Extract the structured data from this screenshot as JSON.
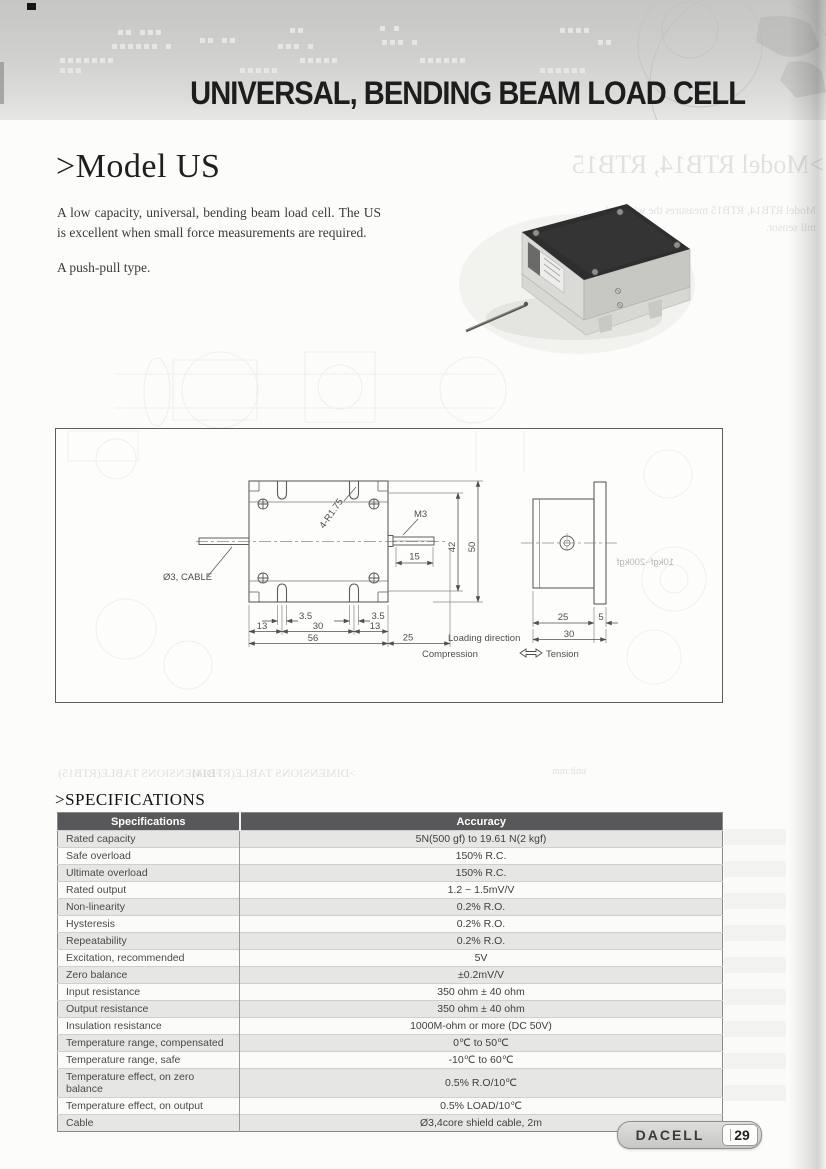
{
  "banner": {
    "title": "UNIVERSAL, BENDING BEAM LOAD CELL"
  },
  "model": {
    "heading": ">Model US",
    "paragraph": "A low capacity, universal, bending beam load cell. The US is excellent when small force measurements are required.",
    "paragraph2": "A push-pull type."
  },
  "ghost": {
    "model_heading": ">Model RTB14, RTB15",
    "model_line1": "Model RTB14, RTB15 measures the wire and",
    "model_line2": "mil sensor.",
    "dims_left": ">DIMENSIONS TABLE(RTB15)",
    "dims_right": ">DIMENSIONS TABLE(RTB14)",
    "unit": "unit:mm",
    "range": "10kgf~200kgf"
  },
  "drawing": {
    "labels": {
      "cable": "Ø3, CABLE",
      "radius": "4-R1.75",
      "thread": "M3",
      "d15": "15",
      "d42": "42",
      "d50": "50",
      "d35": "3.5",
      "d13": "13",
      "d30": "30",
      "d56": "56",
      "d25": "25",
      "s25": "25",
      "s5": "5",
      "s30": "30",
      "loading": "Loading direction",
      "compression": "Compression",
      "tension": "Tension"
    }
  },
  "specifications": {
    "heading": ">SPECIFICATIONS",
    "columns": [
      "Specifications",
      "Accuracy"
    ],
    "rows": [
      [
        "Rated capacity",
        "5N(500 gf) to 19.61 N(2 kgf)"
      ],
      [
        "Safe overload",
        "150% R.C."
      ],
      [
        "Ultimate overload",
        "150% R.C."
      ],
      [
        "Rated output",
        "1.2 ~ 1.5mV/V"
      ],
      [
        "Non-linearity",
        "0.2% R.O."
      ],
      [
        "Hysteresis",
        "0.2% R.O."
      ],
      [
        "Repeatability",
        "0.2% R.O."
      ],
      [
        "Excitation, recommended",
        "5V"
      ],
      [
        "Zero balance",
        "±0.2mV/V"
      ],
      [
        "Input resistance",
        "350 ohm ± 40 ohm"
      ],
      [
        "Output resistance",
        "350 ohm ± 40 ohm"
      ],
      [
        "Insulation resistance",
        "1000M-ohm or more (DC 50V)"
      ],
      [
        "Temperature range, compensated",
        "0℃ to 50℃"
      ],
      [
        "Temperature range, safe",
        "-10℃ to 60℃"
      ],
      [
        "Temperature effect, on zero balance",
        "0.5% R.O/10℃"
      ],
      [
        "Temperature effect, on output",
        "0.5% LOAD/10℃"
      ],
      [
        "Cable",
        "Ø3,4core shield cable, 2m"
      ]
    ]
  },
  "footer": {
    "brand": "DACELL",
    "page_number": "29"
  }
}
